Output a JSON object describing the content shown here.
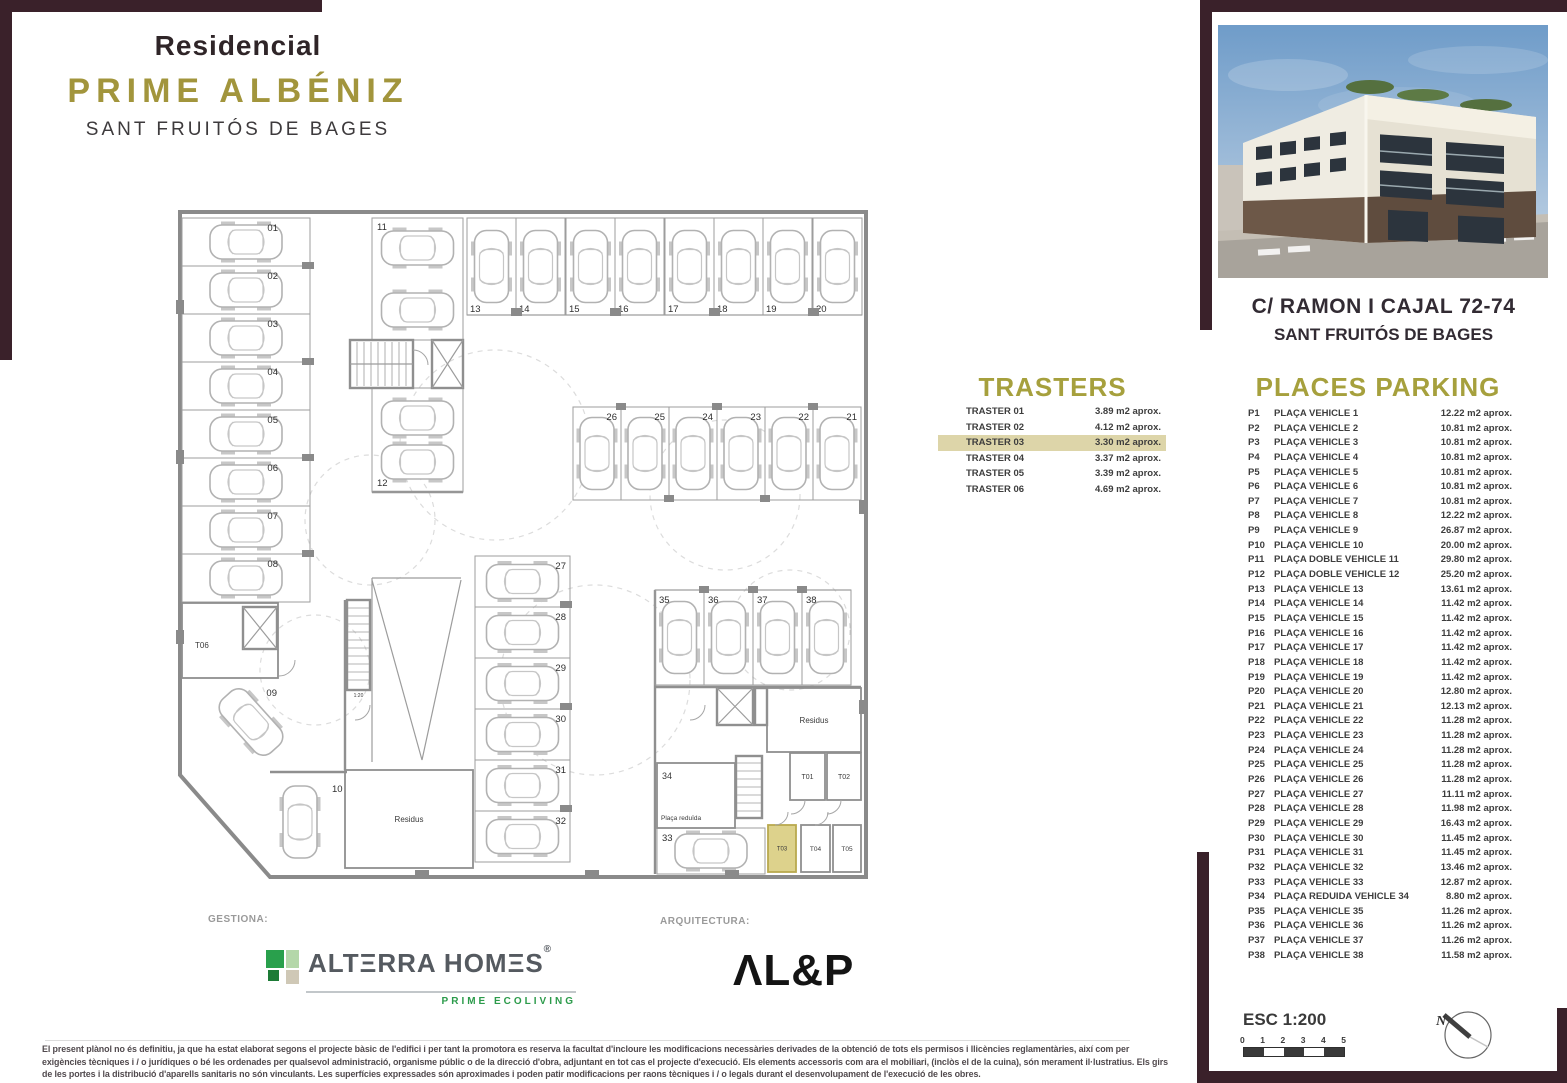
{
  "brand": {
    "line1": "Residencial",
    "line2": "PRIME ALBÉNIZ",
    "line3": "SANT FRUITÓS DE BAGES"
  },
  "address": {
    "line1": "C/ RAMON I CAJAL 72-74",
    "line2": "SANT FRUITÓS DE BAGES"
  },
  "trasters": {
    "title": "TRASTERS",
    "rows": [
      {
        "name": "TRASTER 01",
        "area": "3.89 m2 aprox.",
        "highlight": false
      },
      {
        "name": "TRASTER 02",
        "area": "4.12 m2 aprox.",
        "highlight": false
      },
      {
        "name": "TRASTER 03",
        "area": "3.30 m2 aprox.",
        "highlight": true
      },
      {
        "name": "TRASTER 04",
        "area": "3.37 m2 aprox.",
        "highlight": false
      },
      {
        "name": "TRASTER 05",
        "area": "3.39 m2 aprox.",
        "highlight": false
      },
      {
        "name": "TRASTER 06",
        "area": "4.69 m2 aprox.",
        "highlight": false
      }
    ]
  },
  "parking": {
    "title": "PLACES PARKING",
    "rows": [
      {
        "code": "P1",
        "name": "PLAÇA VEHICLE  1",
        "area": "12.22 m2 aprox."
      },
      {
        "code": "P2",
        "name": "PLAÇA VEHICLE  2",
        "area": "10.81 m2 aprox."
      },
      {
        "code": "P3",
        "name": "PLAÇA VEHICLE  3",
        "area": "10.81 m2 aprox."
      },
      {
        "code": "P4",
        "name": "PLAÇA VEHICLE  4",
        "area": "10.81 m2 aprox."
      },
      {
        "code": "P5",
        "name": "PLAÇA VEHICLE  5",
        "area": "10.81 m2 aprox."
      },
      {
        "code": "P6",
        "name": "PLAÇA VEHICLE  6",
        "area": "10.81 m2 aprox."
      },
      {
        "code": "P7",
        "name": "PLAÇA VEHICLE  7",
        "area": "10.81 m2 aprox."
      },
      {
        "code": "P8",
        "name": "PLAÇA VEHICLE  8",
        "area": "12.22 m2 aprox."
      },
      {
        "code": "P9",
        "name": "PLAÇA VEHICLE  9",
        "area": "26.87 m2 aprox."
      },
      {
        "code": "P10",
        "name": "PLAÇA VEHICLE  10",
        "area": "20.00 m2 aprox."
      },
      {
        "code": "P11",
        "name": "PLAÇA DOBLE VEHICLE  11",
        "area": "29.80 m2 aprox."
      },
      {
        "code": "P12",
        "name": "PLAÇA DOBLE VEHICLE  12",
        "area": "25.20 m2 aprox."
      },
      {
        "code": "P13",
        "name": "PLAÇA VEHICLE  13",
        "area": "13.61 m2 aprox."
      },
      {
        "code": "P14",
        "name": "PLAÇA VEHICLE  14",
        "area": "11.42 m2 aprox."
      },
      {
        "code": "P15",
        "name": "PLAÇA VEHICLE  15",
        "area": "11.42 m2 aprox."
      },
      {
        "code": "P16",
        "name": "PLAÇA VEHICLE  16",
        "area": "11.42 m2 aprox."
      },
      {
        "code": "P17",
        "name": "PLAÇA VEHICLE  17",
        "area": "11.42 m2 aprox."
      },
      {
        "code": "P18",
        "name": "PLAÇA VEHICLE  18",
        "area": "11.42 m2 aprox."
      },
      {
        "code": "P19",
        "name": "PLAÇA VEHICLE  19",
        "area": "11.42 m2 aprox."
      },
      {
        "code": "P20",
        "name": "PLAÇA VEHICLE  20",
        "area": "12.80 m2 aprox."
      },
      {
        "code": "P21",
        "name": "PLAÇA VEHICLE  21",
        "area": "12.13 m2 aprox."
      },
      {
        "code": "P22",
        "name": "PLAÇA VEHICLE  22",
        "area": "11.28 m2 aprox."
      },
      {
        "code": "P23",
        "name": "PLAÇA VEHICLE  23",
        "area": "11.28 m2 aprox."
      },
      {
        "code": "P24",
        "name": "PLAÇA VEHICLE  24",
        "area": "11.28 m2 aprox."
      },
      {
        "code": "P25",
        "name": "PLAÇA VEHICLE  25",
        "area": "11.28 m2 aprox."
      },
      {
        "code": "P26",
        "name": "PLAÇA VEHICLE  26",
        "area": "11.28 m2 aprox."
      },
      {
        "code": "P27",
        "name": "PLAÇA VEHICLE  27",
        "area": "11.11 m2 aprox."
      },
      {
        "code": "P28",
        "name": "PLAÇA VEHICLE  28",
        "area": "11.98 m2 aprox."
      },
      {
        "code": "P29",
        "name": "PLAÇA VEHICLE  29",
        "area": "16.43 m2 aprox."
      },
      {
        "code": "P30",
        "name": "PLAÇA VEHICLE  30",
        "area": "11.45 m2 aprox."
      },
      {
        "code": "P31",
        "name": "PLAÇA VEHICLE  31",
        "area": "11.45 m2 aprox."
      },
      {
        "code": "P32",
        "name": "PLAÇA VEHICLE  32",
        "area": "13.46 m2 aprox."
      },
      {
        "code": "P33",
        "name": "PLAÇA VEHICLE  33",
        "area": "12.87 m2 aprox."
      },
      {
        "code": "P34",
        "name": "PLAÇA REDUIDA VEHICLE  34",
        "area": "8.80 m2 aprox."
      },
      {
        "code": "P35",
        "name": "PLAÇA VEHICLE  35",
        "area": "11.26 m2 aprox."
      },
      {
        "code": "P36",
        "name": "PLAÇA VEHICLE  36",
        "area": "11.26 m2 aprox."
      },
      {
        "code": "P37",
        "name": "PLAÇA VEHICLE  37",
        "area": "11.26 m2 aprox."
      },
      {
        "code": "P38",
        "name": "PLAÇA VEHICLE  38",
        "area": "11.58 m2 aprox."
      }
    ]
  },
  "footer": {
    "gestiona": "GESTIONA:",
    "arquitectura": "ARQUITECTURA:",
    "alterra_name": "ALTERRA HOMES",
    "alterra_display": "ALTΞRRA HOMΞS",
    "alterra_reg": "®",
    "alterra_tagline": "PRIME ECOLIVING",
    "alp_name": "AL&P",
    "alp_display": "ΛL&P"
  },
  "scalebar": {
    "label": "ESC 1:200",
    "ticks": [
      "0",
      "1",
      "2",
      "3",
      "4",
      "5"
    ]
  },
  "compass": {
    "north": "N"
  },
  "disclaimer": {
    "line1": "El present plànol no és definitiu, ja que ha estat elaborat segons el projecte bàsic de l'edifici i per tant la promotora es reserva la facultat d'incloure les modificacions necessàries derivades de la obtenció de tots els permisos i llicències reglamentàries, així com per",
    "line2": "exigències tècniques i / o jurídiques o bé les ordenades per qualsevol administració, organisme públic o de la direcció d'obra, adjuntant en tot cas el projecte d'execució. Els elements accessoris com ara el mobiliari, (inclòs el de la cuina), són merament il·lustratius. Els girs",
    "line3": "de les portes i la distribució d'aparells sanitaris no són vinculants. Les superfícies expressades són aproximades i poden patir modificacions per raons tècniques i / o legals durant el desenvolupament de l'execució de les obres."
  },
  "colors": {
    "gold": "#a2953c",
    "maroon": "#3a212a",
    "highlight_row": "#ddd5a9",
    "traster3_fill": "#ddd28c",
    "wall_gray": "#8a8a8a",
    "logo_green": "#2aa14e"
  },
  "floorplan": {
    "stalls": [
      {
        "label": "01",
        "x": 17,
        "y": 18,
        "w": 128,
        "h": 48,
        "car": "h",
        "lx": 113,
        "ly": 31,
        "anchor": "end"
      },
      {
        "label": "02",
        "x": 17,
        "y": 66,
        "w": 128,
        "h": 48,
        "car": "h",
        "lx": 113,
        "ly": 79,
        "anchor": "end"
      },
      {
        "label": "03",
        "x": 17,
        "y": 114,
        "w": 128,
        "h": 48,
        "car": "h",
        "lx": 113,
        "ly": 127,
        "anchor": "end"
      },
      {
        "label": "04",
        "x": 17,
        "y": 162,
        "w": 128,
        "h": 48,
        "car": "h",
        "lx": 113,
        "ly": 175,
        "anchor": "end"
      },
      {
        "label": "05",
        "x": 17,
        "y": 210,
        "w": 128,
        "h": 48,
        "car": "h",
        "lx": 113,
        "ly": 223,
        "anchor": "end"
      },
      {
        "label": "06",
        "x": 17,
        "y": 258,
        "w": 128,
        "h": 48,
        "car": "h",
        "lx": 113,
        "ly": 271,
        "anchor": "end"
      },
      {
        "label": "07",
        "x": 17,
        "y": 306,
        "w": 128,
        "h": 48,
        "car": "h",
        "lx": 113,
        "ly": 319,
        "anchor": "end"
      },
      {
        "label": "08",
        "x": 17,
        "y": 354,
        "w": 128,
        "h": 48,
        "car": "h",
        "lx": 113,
        "ly": 367,
        "anchor": "end"
      },
      {
        "label": "09",
        "x": 22,
        "y": 468,
        "w": 128,
        "h": 108,
        "car": "diag",
        "lx": 112,
        "ly": 496,
        "anchor": "end",
        "norect": true
      },
      {
        "label": "10",
        "x": 106,
        "y": 576,
        "w": 58,
        "h": 92,
        "car": "v",
        "lx": 167,
        "ly": 592,
        "anchor": "start",
        "norect": true
      },
      {
        "label": "11",
        "x": 207,
        "y": 18,
        "w": 91,
        "h": 122,
        "car": "h2",
        "lx": 212,
        "ly": 30,
        "anchor": "start"
      },
      {
        "label": "12",
        "x": 207,
        "y": 188,
        "w": 91,
        "h": 104,
        "car": "h2",
        "lx": 212,
        "ly": 286,
        "anchor": "start"
      },
      {
        "label": "13",
        "x": 302,
        "y": 18,
        "w": 49,
        "h": 97,
        "car": "v",
        "lx": 305,
        "ly": 112,
        "anchor": "start"
      },
      {
        "label": "14",
        "x": 351,
        "y": 18,
        "w": 49,
        "h": 97,
        "car": "v",
        "lx": 354,
        "ly": 112,
        "anchor": "start"
      },
      {
        "label": "15",
        "x": 401,
        "y": 18,
        "w": 49,
        "h": 97,
        "car": "v",
        "lx": 404,
        "ly": 112,
        "anchor": "start"
      },
      {
        "label": "16",
        "x": 450,
        "y": 18,
        "w": 49,
        "h": 97,
        "car": "v",
        "lx": 453,
        "ly": 112,
        "anchor": "start"
      },
      {
        "label": "17",
        "x": 500,
        "y": 18,
        "w": 49,
        "h": 97,
        "car": "v",
        "lx": 503,
        "ly": 112,
        "anchor": "start"
      },
      {
        "label": "18",
        "x": 549,
        "y": 18,
        "w": 49,
        "h": 97,
        "car": "v",
        "lx": 552,
        "ly": 112,
        "anchor": "start"
      },
      {
        "label": "19",
        "x": 598,
        "y": 18,
        "w": 49,
        "h": 97,
        "car": "v",
        "lx": 601,
        "ly": 112,
        "anchor": "start"
      },
      {
        "label": "20",
        "x": 648,
        "y": 18,
        "w": 49,
        "h": 97,
        "car": "v",
        "lx": 651,
        "ly": 112,
        "anchor": "start"
      },
      {
        "label": "26",
        "x": 408,
        "y": 207,
        "w": 48,
        "h": 93,
        "car": "v",
        "lx": 452,
        "ly": 220,
        "anchor": "end"
      },
      {
        "label": "25",
        "x": 456,
        "y": 207,
        "w": 48,
        "h": 93,
        "car": "v",
        "lx": 500,
        "ly": 220,
        "anchor": "end"
      },
      {
        "label": "24",
        "x": 504,
        "y": 207,
        "w": 48,
        "h": 93,
        "car": "v",
        "lx": 548,
        "ly": 220,
        "anchor": "end"
      },
      {
        "label": "23",
        "x": 552,
        "y": 207,
        "w": 48,
        "h": 93,
        "car": "v",
        "lx": 596,
        "ly": 220,
        "anchor": "end"
      },
      {
        "label": "22",
        "x": 600,
        "y": 207,
        "w": 48,
        "h": 93,
        "car": "v",
        "lx": 644,
        "ly": 220,
        "anchor": "end"
      },
      {
        "label": "21",
        "x": 648,
        "y": 207,
        "w": 48,
        "h": 93,
        "car": "v",
        "lx": 692,
        "ly": 220,
        "anchor": "end"
      },
      {
        "label": "27",
        "x": 310,
        "y": 356,
        "w": 95,
        "h": 51,
        "car": "h",
        "lx": 401,
        "ly": 369,
        "anchor": "end"
      },
      {
        "label": "28",
        "x": 310,
        "y": 407,
        "w": 95,
        "h": 51,
        "car": "h",
        "lx": 401,
        "ly": 420,
        "anchor": "end"
      },
      {
        "label": "29",
        "x": 310,
        "y": 458,
        "w": 95,
        "h": 51,
        "car": "h",
        "lx": 401,
        "ly": 471,
        "anchor": "end"
      },
      {
        "label": "30",
        "x": 310,
        "y": 509,
        "w": 95,
        "h": 51,
        "car": "h",
        "lx": 401,
        "ly": 522,
        "anchor": "end"
      },
      {
        "label": "31",
        "x": 310,
        "y": 560,
        "w": 95,
        "h": 51,
        "car": "h",
        "lx": 401,
        "ly": 573,
        "anchor": "end"
      },
      {
        "label": "32",
        "x": 310,
        "y": 611,
        "w": 95,
        "h": 51,
        "car": "h",
        "lx": 401,
        "ly": 624,
        "anchor": "end"
      },
      {
        "label": "33",
        "x": 492,
        "y": 628,
        "w": 108,
        "h": 46,
        "car": "h",
        "lx": 497,
        "ly": 641,
        "anchor": "start"
      },
      {
        "label": "35",
        "x": 490,
        "y": 390,
        "w": 49,
        "h": 95,
        "car": "v",
        "lx": 494,
        "ly": 403,
        "anchor": "start"
      },
      {
        "label": "36",
        "x": 539,
        "y": 390,
        "w": 49,
        "h": 95,
        "car": "v",
        "lx": 543,
        "ly": 403,
        "anchor": "start"
      },
      {
        "label": "37",
        "x": 588,
        "y": 390,
        "w": 49,
        "h": 95,
        "car": "v",
        "lx": 592,
        "ly": 403,
        "anchor": "start"
      },
      {
        "label": "38",
        "x": 637,
        "y": 390,
        "w": 49,
        "h": 95,
        "car": "v",
        "lx": 641,
        "ly": 403,
        "anchor": "start"
      }
    ],
    "rooms": [
      {
        "label": "T06",
        "x": 17,
        "y": 403,
        "w": 96,
        "h": 75,
        "lx": 30,
        "ly": 448,
        "fs": 8
      },
      {
        "label": "34",
        "x": 492,
        "y": 563,
        "w": 78,
        "h": 65,
        "lx": 497,
        "ly": 579,
        "fs": 9
      },
      {
        "label": "Plaça reduïda",
        "x": 492,
        "y": 563,
        "w": 78,
        "h": 65,
        "lx": 496,
        "ly": 620,
        "fs": 6.5,
        "rect": false
      },
      {
        "label": "T01",
        "x": 625,
        "y": 553,
        "w": 35,
        "h": 47,
        "fs": 7,
        "cx": true
      },
      {
        "label": "T02",
        "x": 662,
        "y": 553,
        "w": 34,
        "h": 47,
        "fs": 7,
        "cx": true
      },
      {
        "label": "T03",
        "x": 603,
        "y": 625,
        "w": 28,
        "h": 47,
        "fs": 6,
        "cx": true,
        "fill": "#ddd28c",
        "stroke": "#b9a94e"
      },
      {
        "label": "T04",
        "x": 636,
        "y": 625,
        "w": 29,
        "h": 47,
        "fs": 6.5,
        "cx": true
      },
      {
        "label": "T05",
        "x": 668,
        "y": 625,
        "w": 28,
        "h": 47,
        "fs": 6.5,
        "cx": true
      },
      {
        "label": "Residus",
        "x": 180,
        "y": 570,
        "w": 128,
        "h": 98,
        "fs": 8,
        "cx": true
      },
      {
        "label": "Residus",
        "x": 602,
        "y": 488,
        "w": 94,
        "h": 64,
        "fs": 8,
        "cx": true
      },
      {
        "label": "1:20",
        "x": 182,
        "y": 489,
        "w": 23,
        "h": 13,
        "fs": 5,
        "cx": true,
        "rect": false
      }
    ]
  }
}
